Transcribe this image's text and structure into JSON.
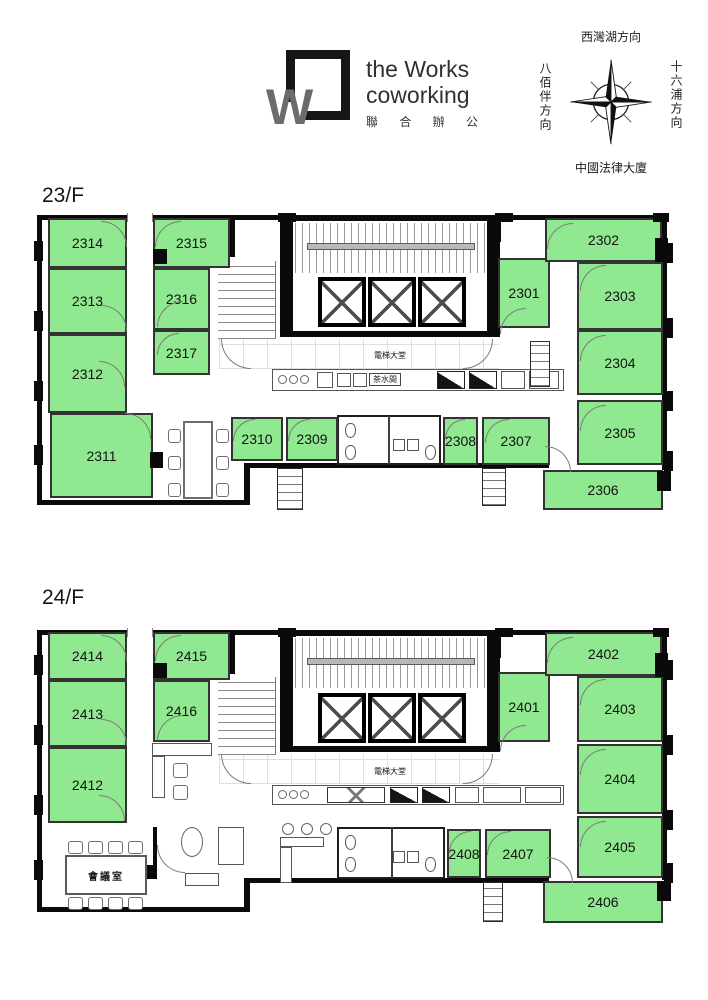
{
  "header": {
    "logo": {
      "title_line1": "the Works",
      "title_line2": "coworking",
      "subtitle": "聯 合 辦 公"
    },
    "compass": {
      "north": "西灣湖方向",
      "east": "十六浦方向",
      "south": "中國法律大廈",
      "west": "八佰伴方向"
    }
  },
  "colors": {
    "room_green": "#90E890",
    "wall": "#0A0A0A"
  },
  "floors": [
    {
      "label": "23/F",
      "lobby_label": "電梯大堂",
      "pantry_label": "茶水間",
      "rooms": [
        {
          "number": "2301",
          "rect": [
            463,
            45,
            52,
            70
          ]
        },
        {
          "number": "2302",
          "rect": [
            510,
            5,
            117,
            44
          ]
        },
        {
          "number": "2303",
          "rect": [
            542,
            49,
            86,
            68
          ]
        },
        {
          "number": "2304",
          "rect": [
            542,
            117,
            86,
            65
          ]
        },
        {
          "number": "2305",
          "rect": [
            542,
            187,
            86,
            65
          ]
        },
        {
          "number": "2306",
          "rect": [
            508,
            257,
            120,
            40
          ]
        },
        {
          "number": "2307",
          "rect": [
            447,
            204,
            68,
            48
          ]
        },
        {
          "number": "2308",
          "rect": [
            408,
            204,
            35,
            48
          ]
        },
        {
          "number": "2309",
          "rect": [
            251,
            204,
            52,
            44
          ]
        },
        {
          "number": "2310",
          "rect": [
            196,
            204,
            52,
            44
          ]
        },
        {
          "number": "2311",
          "rect": [
            15,
            200,
            103,
            85
          ]
        },
        {
          "number": "2312",
          "rect": [
            13,
            121,
            79,
            79
          ]
        },
        {
          "number": "2313",
          "rect": [
            13,
            55,
            79,
            66
          ]
        },
        {
          "number": "2314",
          "rect": [
            13,
            5,
            79,
            50
          ]
        },
        {
          "number": "2315",
          "rect": [
            118,
            5,
            77,
            50
          ]
        },
        {
          "number": "2316",
          "rect": [
            118,
            55,
            57,
            62
          ]
        },
        {
          "number": "2317",
          "rect": [
            118,
            117,
            57,
            45
          ]
        }
      ]
    },
    {
      "label": "24/F",
      "lobby_label": "電梯大堂",
      "meeting_room_label": "會議室",
      "rooms": [
        {
          "number": "2401",
          "rect": [
            463,
            57,
            52,
            70
          ]
        },
        {
          "number": "2402",
          "rect": [
            510,
            17,
            117,
            44
          ]
        },
        {
          "number": "2403",
          "rect": [
            542,
            61,
            86,
            66
          ]
        },
        {
          "number": "2404",
          "rect": [
            542,
            129,
            86,
            70
          ]
        },
        {
          "number": "2405",
          "rect": [
            542,
            201,
            86,
            62
          ]
        },
        {
          "number": "2406",
          "rect": [
            508,
            266,
            120,
            42
          ]
        },
        {
          "number": "2407",
          "rect": [
            450,
            214,
            66,
            49
          ]
        },
        {
          "number": "2408",
          "rect": [
            412,
            214,
            34,
            49
          ]
        },
        {
          "number": "2412",
          "rect": [
            13,
            132,
            79,
            76
          ]
        },
        {
          "number": "2413",
          "rect": [
            13,
            65,
            79,
            67
          ]
        },
        {
          "number": "2414",
          "rect": [
            13,
            17,
            79,
            48
          ]
        },
        {
          "number": "2415",
          "rect": [
            118,
            17,
            77,
            48
          ]
        },
        {
          "number": "2416",
          "rect": [
            118,
            65,
            57,
            62
          ]
        }
      ]
    }
  ]
}
